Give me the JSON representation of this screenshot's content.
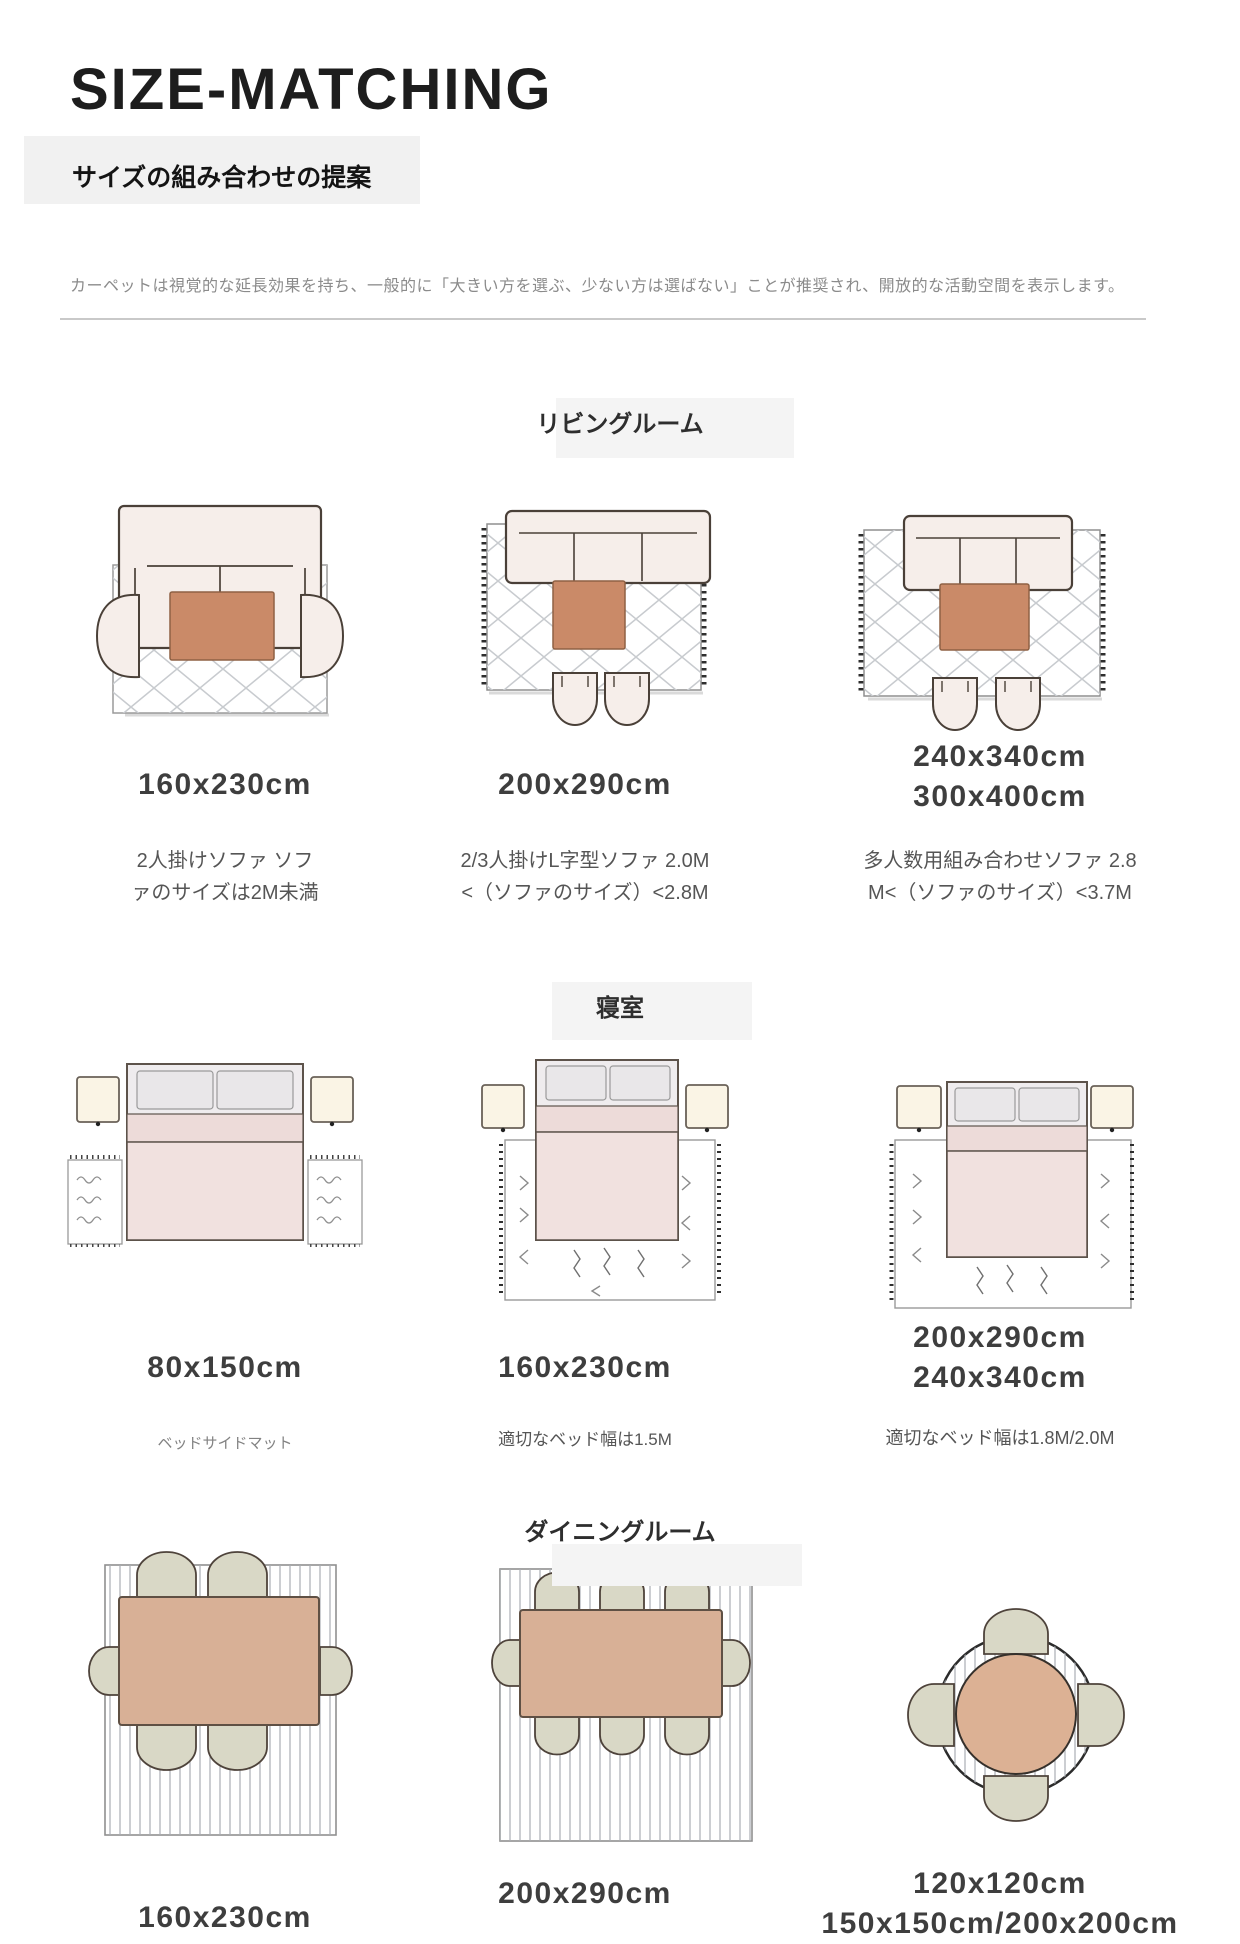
{
  "page": {
    "title": "SIZE-MATCHING",
    "subtitle": "サイズの組み合わせの提案",
    "description": "カーペットは視覚的な延長効果を持ち、一般的に「大きい方を選ぶ、少ない方は選ばない」ことが推奨され、開放的な活動空間を表示します。"
  },
  "sections": [
    {
      "id": "living-room",
      "heading": "リビングルーム",
      "items": [
        {
          "illustration": "two-seat-sofa-two-armchairs-on-lattice-rug",
          "sizes": [
            "160x230cm"
          ],
          "description_lines": [
            "2人掛けソファ ソフ",
            "ァのサイズは2M未満"
          ]
        },
        {
          "illustration": "sofa-coffee-table-two-ottomans-on-fringed-lattice-rug",
          "sizes": [
            "200x290cm"
          ],
          "description_lines": [
            "2/3人掛けL字型ソファ 2.0M",
            "<（ソファのサイズ）<2.8M"
          ]
        },
        {
          "illustration": "large-sofa-coffee-table-two-ottomans-on-fringed-lattice-rug",
          "sizes": [
            "240x340cm",
            "300x400cm"
          ],
          "description_lines": [
            "多人数用組み合わせソファ 2.8",
            "M<（ソファのサイズ）<3.7M"
          ]
        }
      ]
    },
    {
      "id": "bedroom",
      "heading": "寝室",
      "items": [
        {
          "illustration": "bed-with-two-bedside-mats-and-lamps",
          "sizes": [
            "80x150cm"
          ],
          "description_lines": [
            "ベッドサイドマット"
          ]
        },
        {
          "illustration": "bed-on-tasseled-rug-with-lamps",
          "sizes": [
            "160x230cm"
          ],
          "description_lines": [
            "適切なベッド幅は1.5M"
          ]
        },
        {
          "illustration": "bed-on-large-tasseled-rug-with-lamps",
          "sizes": [
            "200x290cm",
            "240x340cm"
          ],
          "description_lines": [
            "適切なベッド幅は1.8M/2.0M"
          ]
        }
      ]
    },
    {
      "id": "dining-room",
      "heading": "ダイニングルーム",
      "items": [
        {
          "illustration": "dining-table-six-chairs-on-striped-rug",
          "sizes": [
            "160x230cm"
          ],
          "description_lines": []
        },
        {
          "illustration": "dining-table-eight-chairs-on-striped-rug",
          "sizes": [
            "200x290cm"
          ],
          "description_lines": []
        },
        {
          "illustration": "round-dining-table-four-chairs-on-round-striped-rug",
          "sizes": [
            "120x120cm",
            "150x150cm/200x200cm"
          ],
          "description_lines": []
        }
      ]
    }
  ],
  "colors": {
    "coffee_table_terracotta": "#ca8a68",
    "dining_table_tan": "#d8b096",
    "chair_sage": "#d9d8c6",
    "blanket_pink": "#f0dedd",
    "upholstery_blush": "#f6eeea",
    "lamp_cream": "#faf4e5",
    "heading_patch_gray": "#f3f3f3",
    "label_gray": "#3e3e3e"
  }
}
